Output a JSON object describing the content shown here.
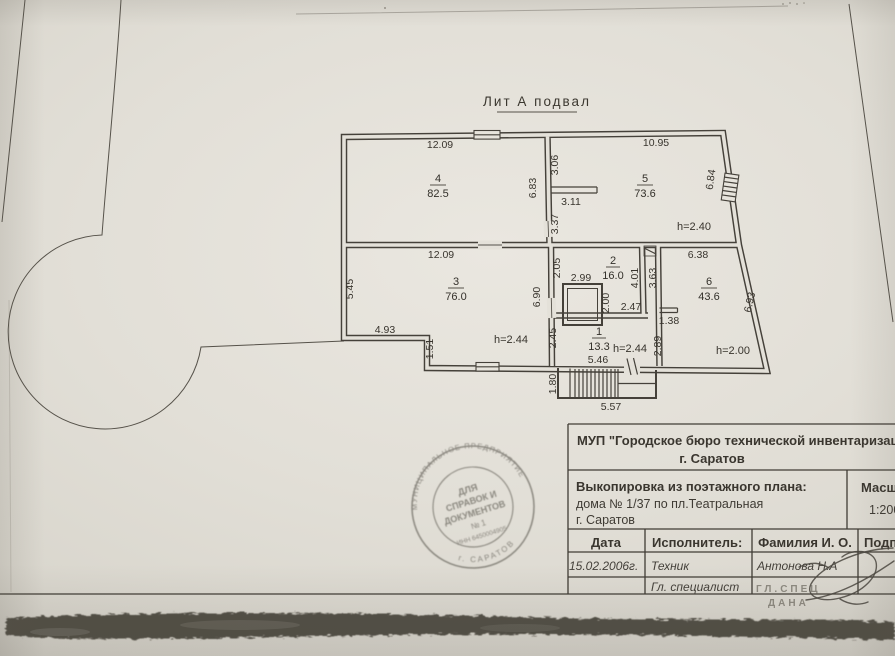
{
  "colors": {
    "paper": "#e4e1d9",
    "ink": "#45413a",
    "stamp_ink": "#4c4840"
  },
  "plan": {
    "title": "Лит А подвал",
    "room4_num": "4",
    "room4_area": "82.5",
    "room5_num": "5",
    "room5_area": "73.6",
    "room3_num": "3",
    "room3_area": "76.0",
    "room2_num": "2",
    "room2_area": "16.0",
    "room1_num": "1",
    "room1_area": "13.3",
    "room6_num": "6",
    "room6_area": "43.6",
    "dim_room4_top": "12.09",
    "dim_room5_top": "10.95",
    "dim_wall45_side": "6.83",
    "dim_wall45_upper": "3.06",
    "dim_partition_stub": "3.11",
    "dim_wall45_lower": "3.37",
    "dim_room5_right": "6.84",
    "height_room5": "h=2.40",
    "dim_room3_top": "12.09",
    "dim_room3_left": "5.45",
    "dim_step_width": "4.93",
    "dim_step_height": "1.51",
    "height_room3": "h=2.44",
    "dim_center_wall": "6.90",
    "dim_room2_left": "2.05",
    "dim_shaft_top": "2.99",
    "dim_shaft_right": "2.00",
    "dim_shaft_bottom": "2.47",
    "dim_room2_right": "4.01",
    "dim_room6_wall": "3.63",
    "dim_stub6": "1.38",
    "dim_room6_top": "6.38",
    "dim_room6_right": "6.93",
    "dim_room1_left": "2.45",
    "height_room1": "h=2.44",
    "dim_room1_right": "2.89",
    "height_room6": "h=2.00",
    "dim_room1_bottom": "5.46",
    "dim_stairs_depth": "1.80",
    "dim_stairs_width": "5.57"
  },
  "tb": {
    "org_line1": "МУП \"Городское бюро технической инвентаризации\"",
    "org_line2": "г. Саратов",
    "doc_line1": "Выкопировка из поэтажного плана:",
    "doc_line2": "дома № 1/37  по пл.Театральная",
    "doc_line3": "г. Саратов",
    "scale_label": "Масштаб",
    "scale_value": "1:200",
    "col_date": "Дата",
    "col_executor": "Исполнитель:",
    "col_name": "Фамилия И. О.",
    "col_sign": "Подпись",
    "date_value": "15.02.2006г.",
    "executor_value": "Техник",
    "name_value": "Антонова Н.А",
    "row2_role": "Гл. специалист",
    "row2_stamp_line1": "ГЛ.СПЕЦ",
    "row2_stamp_line2": "ДАНА"
  },
  "stamp": {
    "ring_top": "МУНИЦИПАЛЬНОЕ ПРЕДПРИЯТИЕ",
    "ring_bottom": "г. САРАТОВ",
    "line1": "ДЛЯ",
    "line2": "СПРАВОК И",
    "line3": "ДОКУМЕНТОВ",
    "line4": "№ 1",
    "line5": "ИНН 6450004905"
  }
}
